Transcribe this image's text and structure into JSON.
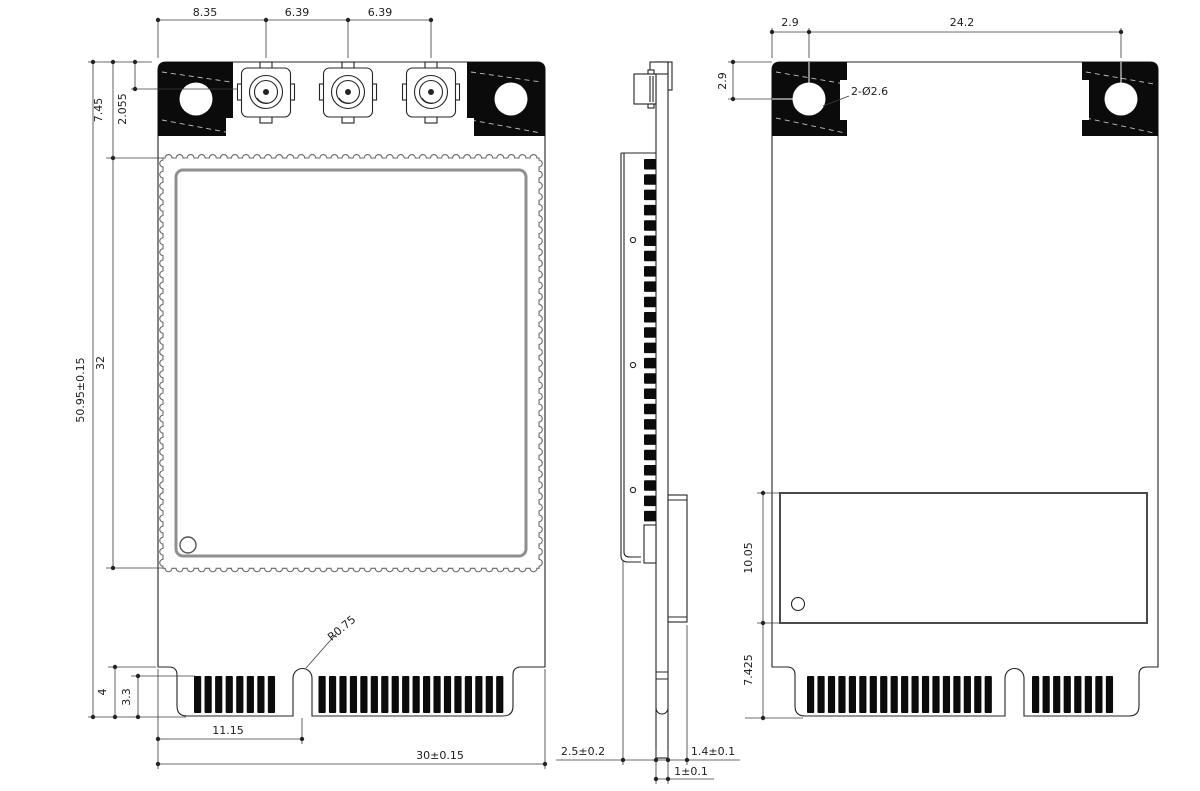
{
  "drawing": {
    "type": "mechanical-dimension-drawing",
    "colors": {
      "outline": "#242424",
      "dimension_line": "#3c3c3c",
      "dark_fill": "#0b0b0b",
      "shield_gray": "#8f8f8f",
      "background": "#ffffff"
    },
    "front": {
      "dims_top": [
        "8.35",
        "6.39",
        "6.39"
      ],
      "dim_shield_offset": "7.45",
      "dim_connector_offset": "2.055",
      "dim_length": "50.95±0.15",
      "dim_shield_length": "32",
      "dim_edge_step": "4",
      "dim_finger_depth": "3.3",
      "dim_notch_offset": "11.15",
      "dim_width": "30±0.15",
      "dim_notch_radius": "R0.75",
      "pins_left": 8,
      "pins_right": 18,
      "rf_connector_count": 3
    },
    "side": {
      "dim_total_thickness": "2.5±0.2",
      "dim_pcb_thickness": "1±0.1",
      "dim_back_component_height": "1.4±0.1",
      "shield_contacts": 24
    },
    "back": {
      "dim_hole_offset_x": "2.9",
      "dim_hole_pitch": "24.2",
      "dim_hole_offset_y": "2.9",
      "dim_hole_diameter": "2-Ø2.6",
      "dim_shield_height": "10.05",
      "dim_shield_to_edge": "7.425",
      "pins_left": 18,
      "pins_right": 8
    }
  }
}
